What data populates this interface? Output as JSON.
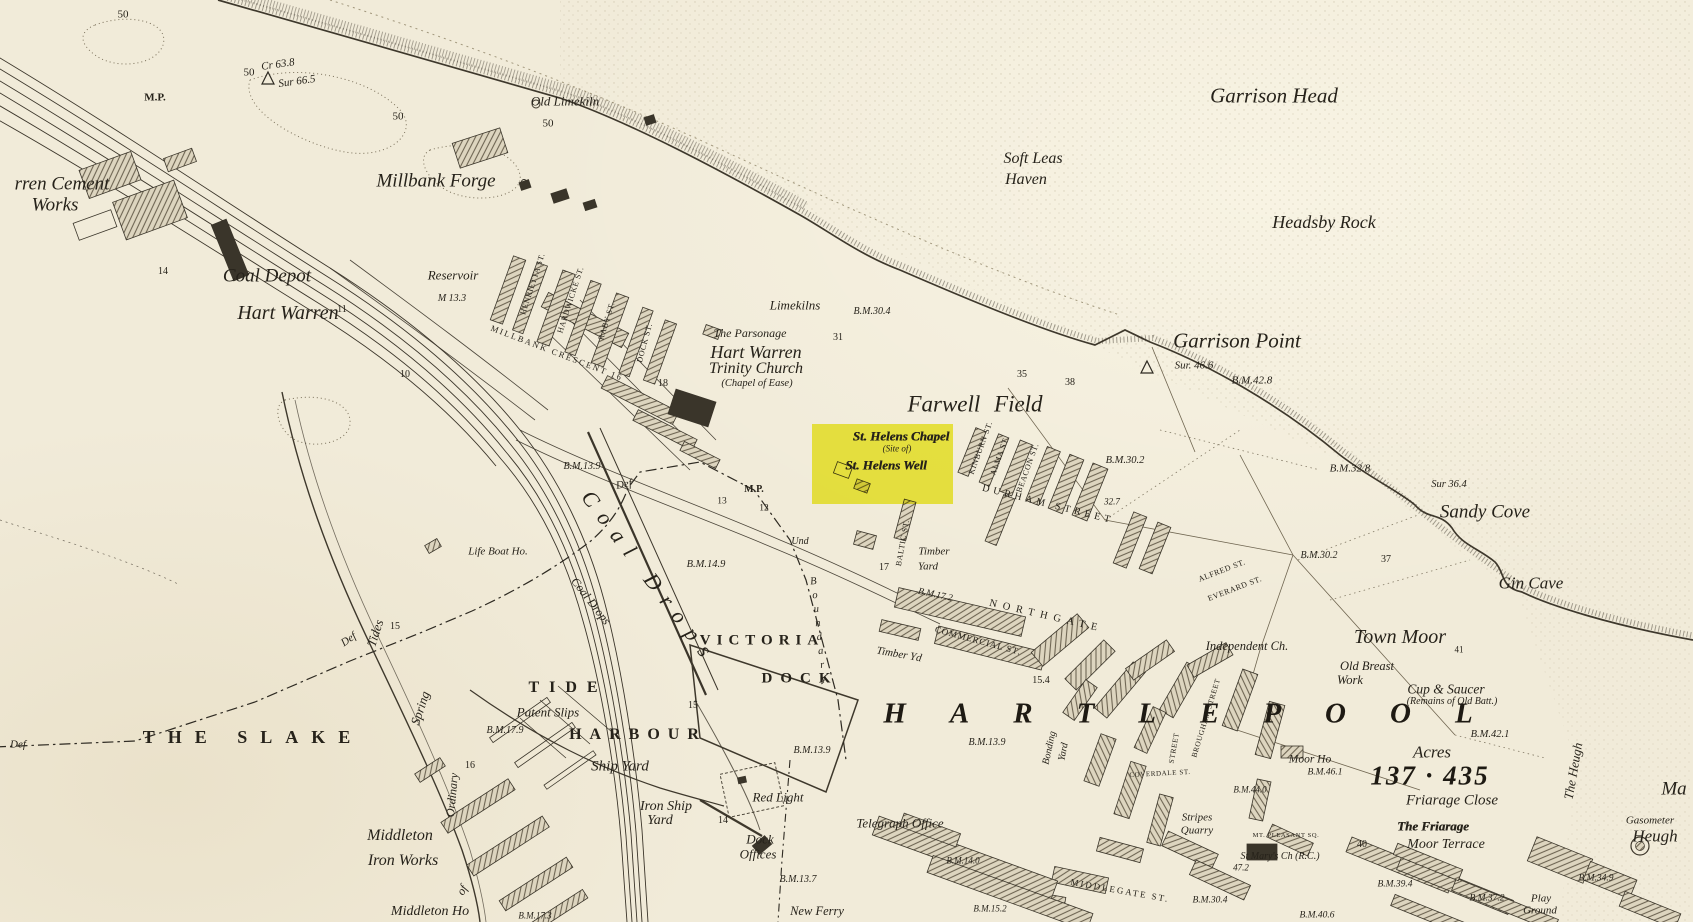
{
  "map_meta": {
    "kind": "historical-ordnance-survey-town-map",
    "highlight_color": "#f0ee2e",
    "paper_color": "#f1ebd9",
    "ink_color": "#2b271f"
  },
  "highlight": {
    "name": "site-of-st-helens-well",
    "fill": "#f0ee2e",
    "lines": [
      "St. Helens Chapel",
      "(Site of)",
      "St. Helens Well"
    ]
  },
  "labels": [
    {
      "t": "50",
      "x": 123,
      "y": 15,
      "s": "num",
      "fs": 11
    },
    {
      "t": "M.P.",
      "x": 155,
      "y": 98,
      "s": "numb",
      "fs": 11
    },
    {
      "t": "Cr 63.8",
      "x": 278,
      "y": 65,
      "s": "bm",
      "fs": 11,
      "r": -8
    },
    {
      "t": "Sur 66.5",
      "x": 297,
      "y": 82,
      "s": "bm",
      "fs": 11,
      "r": -8
    },
    {
      "t": "50",
      "x": 249,
      "y": 73,
      "s": "num",
      "fs": 11
    },
    {
      "t": "50",
      "x": 398,
      "y": 117,
      "s": "num",
      "fs": 11
    },
    {
      "t": "50",
      "x": 548,
      "y": 124,
      "s": "num",
      "fs": 11
    },
    {
      "t": "Old Limekiln",
      "x": 565,
      "y": 101,
      "s": "pl",
      "fs": 13
    },
    {
      "t": "Garrison Head",
      "x": 1274,
      "y": 96,
      "s": "pl",
      "fs": 21
    },
    {
      "t": "Soft Leas",
      "x": 1033,
      "y": 159,
      "s": "pl",
      "fs": 16
    },
    {
      "t": "Haven",
      "x": 1026,
      "y": 180,
      "s": "pl",
      "fs": 16
    },
    {
      "t": "Headsby Rock",
      "x": 1324,
      "y": 222,
      "s": "pl",
      "fs": 18
    },
    {
      "t": "rren Cement",
      "x": 62,
      "y": 184,
      "s": "pl",
      "fs": 19
    },
    {
      "t": "Works",
      "x": 55,
      "y": 205,
      "s": "pl",
      "fs": 19
    },
    {
      "t": "Millbank Forge",
      "x": 436,
      "y": 181,
      "s": "pl",
      "fs": 19
    },
    {
      "t": "Coal Depot",
      "x": 267,
      "y": 276,
      "s": "pl",
      "fs": 19
    },
    {
      "t": "Hart Warren",
      "x": 288,
      "y": 313,
      "s": "pl",
      "fs": 20
    },
    {
      "t": "Reservoir",
      "x": 453,
      "y": 275,
      "s": "pl",
      "fs": 13
    },
    {
      "t": "M 13.3",
      "x": 452,
      "y": 299,
      "s": "bm",
      "fs": 10
    },
    {
      "t": "14",
      "x": 163,
      "y": 272,
      "s": "num",
      "fs": 10
    },
    {
      "t": "11",
      "x": 342,
      "y": 310,
      "s": "num",
      "fs": 10
    },
    {
      "t": "10",
      "x": 405,
      "y": 375,
      "s": "num",
      "fs": 10
    },
    {
      "t": "HENRIETTA ST.",
      "x": 533,
      "y": 284,
      "s": "st",
      "fs": 8,
      "r": -72
    },
    {
      "t": "HARDWICKE ST.",
      "x": 571,
      "y": 300,
      "s": "st",
      "fs": 8,
      "r": -72
    },
    {
      "t": "RABY ST.",
      "x": 607,
      "y": 321,
      "s": "st",
      "fs": 8,
      "r": -73
    },
    {
      "t": "DOCK ST.",
      "x": 645,
      "y": 343,
      "s": "st",
      "fs": 8,
      "r": -75
    },
    {
      "t": "MILLBANK CRESCENT 16",
      "x": 557,
      "y": 353,
      "s": "st",
      "fs": 8.5,
      "ls": 2,
      "r": 21
    },
    {
      "t": "Limekilns",
      "x": 795,
      "y": 305,
      "s": "pl",
      "fs": 13
    },
    {
      "t": "The Parsonage",
      "x": 750,
      "y": 333,
      "s": "pl",
      "fs": 12
    },
    {
      "t": "Hart Warren",
      "x": 756,
      "y": 352,
      "s": "pl",
      "fs": 18
    },
    {
      "t": "Trinity Church",
      "x": 756,
      "y": 369,
      "s": "pl",
      "fs": 16
    },
    {
      "t": "(Chapel of Ease)",
      "x": 757,
      "y": 384,
      "s": "pl",
      "fs": 10.5
    },
    {
      "t": "18",
      "x": 663,
      "y": 384,
      "s": "num",
      "fs": 10
    },
    {
      "t": "31",
      "x": 838,
      "y": 338,
      "s": "num",
      "fs": 10
    },
    {
      "t": "B.M.30.4",
      "x": 872,
      "y": 312,
      "s": "bm",
      "fs": 10
    },
    {
      "t": "35",
      "x": 1022,
      "y": 375,
      "s": "num",
      "fs": 10
    },
    {
      "t": "38",
      "x": 1070,
      "y": 383,
      "s": "num",
      "fs": 10
    },
    {
      "t": "Garrison Point",
      "x": 1237,
      "y": 341,
      "s": "pl",
      "fs": 21
    },
    {
      "t": "Sur. 46.6",
      "x": 1194,
      "y": 366,
      "s": "bm",
      "fs": 11
    },
    {
      "t": "B.M.42.8",
      "x": 1252,
      "y": 381,
      "s": "bm",
      "fs": 11
    },
    {
      "t": "Farwell Field",
      "x": 975,
      "y": 404,
      "s": "pl",
      "fs": 23,
      "ws": 8
    },
    {
      "t": "St. Helens Chapel",
      "x": 901,
      "y": 436,
      "s": "bl",
      "fs": 13
    },
    {
      "t": "(Site of)",
      "x": 897,
      "y": 449,
      "s": "pl",
      "fs": 9
    },
    {
      "t": "St. Helens Well",
      "x": 886,
      "y": 465,
      "s": "bl",
      "fs": 13
    },
    {
      "t": "KINBURN ST.",
      "x": 981,
      "y": 448,
      "s": "st",
      "fs": 8,
      "r": -70
    },
    {
      "t": "ALMA ST.",
      "x": 1000,
      "y": 456,
      "s": "st",
      "fs": 8,
      "r": -70
    },
    {
      "t": "BEACON ST.",
      "x": 1028,
      "y": 468,
      "s": "st",
      "fs": 8,
      "r": -70
    },
    {
      "t": "B.M.30.2",
      "x": 1125,
      "y": 461,
      "s": "bm",
      "fs": 10.5
    },
    {
      "t": "DURHAM STREET",
      "x": 1048,
      "y": 505,
      "s": "st",
      "fs": 10,
      "ls": 4,
      "r": 14
    },
    {
      "t": "32.7",
      "x": 1112,
      "y": 502,
      "s": "bm",
      "fs": 9
    },
    {
      "t": "B.M.32.8",
      "x": 1350,
      "y": 469,
      "s": "bm",
      "fs": 11
    },
    {
      "t": "Sur 36.4",
      "x": 1449,
      "y": 485,
      "s": "bm",
      "fs": 10.5
    },
    {
      "t": "Sandy Cove",
      "x": 1485,
      "y": 512,
      "s": "pl",
      "fs": 19
    },
    {
      "t": "B.M.30.2",
      "x": 1319,
      "y": 556,
      "s": "bm",
      "fs": 10
    },
    {
      "t": "37",
      "x": 1386,
      "y": 560,
      "s": "num",
      "fs": 10
    },
    {
      "t": "Gin Cave",
      "x": 1531,
      "y": 583,
      "s": "pl",
      "fs": 17
    },
    {
      "t": "ALFRED ST.",
      "x": 1222,
      "y": 571,
      "s": "st",
      "fs": 8,
      "r": -21
    },
    {
      "t": "EVERARD ST.",
      "x": 1235,
      "y": 589,
      "s": "st",
      "fs": 8,
      "r": -21
    },
    {
      "t": "Town Moor",
      "x": 1400,
      "y": 637,
      "s": "pl",
      "fs": 20
    },
    {
      "t": "41",
      "x": 1459,
      "y": 650,
      "s": "num",
      "fs": 9
    },
    {
      "t": "Independent Ch.",
      "x": 1247,
      "y": 646,
      "s": "pl",
      "fs": 12.5
    },
    {
      "t": "Old Breast",
      "x": 1367,
      "y": 666,
      "s": "pl",
      "fs": 12.5
    },
    {
      "t": "Work",
      "x": 1350,
      "y": 680,
      "s": "pl",
      "fs": 12.5
    },
    {
      "t": "Cup & Saucer",
      "x": 1446,
      "y": 689,
      "s": "pl",
      "fs": 13.5
    },
    {
      "t": "(Remains of Old Batt.)",
      "x": 1452,
      "y": 702,
      "s": "pl",
      "fs": 10
    },
    {
      "t": "B.M.42.1",
      "x": 1490,
      "y": 735,
      "s": "bm",
      "fs": 10.5
    },
    {
      "t": "Acres",
      "x": 1432,
      "y": 752,
      "s": "pl",
      "fs": 17
    },
    {
      "t": "137 · 435",
      "x": 1430,
      "y": 776,
      "s": "town",
      "fs": 27,
      "ls": 2
    },
    {
      "t": "Friarage Close",
      "x": 1452,
      "y": 801,
      "s": "pl",
      "fs": 15
    },
    {
      "t": "The Friarage",
      "x": 1433,
      "y": 826,
      "s": "bl",
      "fs": 13
    },
    {
      "t": "Moor Terrace",
      "x": 1446,
      "y": 845,
      "s": "pl",
      "fs": 14
    },
    {
      "t": "The Heugh",
      "x": 1573,
      "y": 771,
      "s": "pl",
      "fs": 13,
      "r": -80
    },
    {
      "t": "Gasometer",
      "x": 1650,
      "y": 821,
      "s": "pl",
      "fs": 11
    },
    {
      "t": "Heugh",
      "x": 1655,
      "y": 836,
      "s": "pl",
      "fs": 17
    },
    {
      "t": "Ma",
      "x": 1674,
      "y": 789,
      "s": "pl",
      "fs": 19
    },
    {
      "t": "Moor Ho",
      "x": 1310,
      "y": 760,
      "s": "pl",
      "fs": 11.5
    },
    {
      "t": "B.M.46.1",
      "x": 1325,
      "y": 773,
      "s": "bm",
      "fs": 9.5
    },
    {
      "t": "40",
      "x": 1362,
      "y": 845,
      "s": "num",
      "fs": 10
    },
    {
      "t": "MT. PLEASANT SQ.",
      "x": 1286,
      "y": 836,
      "s": "st",
      "fs": 6.5
    },
    {
      "t": "St Mary's Ch (R.C.)",
      "x": 1280,
      "y": 857,
      "s": "pl",
      "fs": 10
    },
    {
      "t": "47.2",
      "x": 1241,
      "y": 868,
      "s": "bm",
      "fs": 9
    },
    {
      "t": "Stripes",
      "x": 1197,
      "y": 818,
      "s": "pl",
      "fs": 11
    },
    {
      "t": "Quarry",
      "x": 1197,
      "y": 831,
      "s": "pl",
      "fs": 11
    },
    {
      "t": "COVERDALE ST.",
      "x": 1160,
      "y": 774,
      "s": "st",
      "fs": 7,
      "r": -3
    },
    {
      "t": "BROUGHAM STREET",
      "x": 1206,
      "y": 718,
      "s": "st",
      "fs": 7.5,
      "r": -73
    },
    {
      "t": "STREET",
      "x": 1174,
      "y": 748,
      "s": "st",
      "fs": 7.5,
      "r": -80
    },
    {
      "t": "MIDDLEGATE ST.",
      "x": 1120,
      "y": 891,
      "s": "st",
      "fs": 9,
      "ls": 2,
      "r": 10
    },
    {
      "t": "B.M.30.4",
      "x": 1210,
      "y": 901,
      "s": "bm",
      "fs": 9.5
    },
    {
      "t": "B.M.44.0",
      "x": 1250,
      "y": 790,
      "s": "bm",
      "fs": 9
    },
    {
      "t": "B.M.39.4",
      "x": 1395,
      "y": 885,
      "s": "bm",
      "fs": 9.5
    },
    {
      "t": "B.M.37.2",
      "x": 1487,
      "y": 899,
      "s": "bm",
      "fs": 9.5
    },
    {
      "t": "Play",
      "x": 1541,
      "y": 899,
      "s": "pl",
      "fs": 11
    },
    {
      "t": "Ground",
      "x": 1540,
      "y": 911,
      "s": "pl",
      "fs": 11
    },
    {
      "t": "B.M.34.9",
      "x": 1596,
      "y": 879,
      "s": "bm",
      "fs": 9.5
    },
    {
      "t": "B.M.40.6",
      "x": 1317,
      "y": 916,
      "s": "bm",
      "fs": 9.5
    },
    {
      "t": "HARTLEPOOL",
      "x": 1200,
      "y": 714,
      "s": "town",
      "fs": 29,
      "ls": 44
    },
    {
      "t": "Bonding",
      "x": 1050,
      "y": 748,
      "s": "pl",
      "fs": 10,
      "r": -78
    },
    {
      "t": "Yard",
      "x": 1064,
      "y": 752,
      "s": "pl",
      "fs": 10,
      "r": -78
    },
    {
      "t": "B.M.13.9",
      "x": 987,
      "y": 743,
      "s": "bm",
      "fs": 10
    },
    {
      "t": "B.M.13.9",
      "x": 812,
      "y": 751,
      "s": "bm",
      "fs": 10
    },
    {
      "t": "15.4",
      "x": 1041,
      "y": 681,
      "s": "num",
      "fs": 10
    },
    {
      "t": "COMMERCIAL ST.",
      "x": 978,
      "y": 641,
      "s": "st",
      "fs": 9,
      "ls": 1,
      "r": 15
    },
    {
      "t": "NORTHGATE",
      "x": 1046,
      "y": 617,
      "s": "st",
      "fs": 10.5,
      "ls": 6,
      "r": 13
    },
    {
      "t": "B.M.17.2",
      "x": 935,
      "y": 596,
      "s": "bm",
      "fs": 9.5,
      "r": 12
    },
    {
      "t": "Timber Yd",
      "x": 899,
      "y": 655,
      "s": "pl",
      "fs": 11,
      "r": 10
    },
    {
      "t": "VICTORIA",
      "x": 762,
      "y": 641,
      "s": "sp",
      "fs": 15,
      "ls": 6
    },
    {
      "t": "DOCK",
      "x": 800,
      "y": 679,
      "s": "sp",
      "fs": 15,
      "ls": 8
    },
    {
      "t": "TIDE",
      "x": 568,
      "y": 688,
      "s": "sp",
      "fs": 16,
      "ls": 10
    },
    {
      "t": "HARBOUR",
      "x": 638,
      "y": 735,
      "s": "sp",
      "fs": 16,
      "ls": 8
    },
    {
      "t": "THE SLAKE",
      "x": 253,
      "y": 737,
      "s": "sp",
      "fs": 18,
      "ls": 13
    },
    {
      "t": "Patent Slips",
      "x": 548,
      "y": 712,
      "s": "pl",
      "fs": 13
    },
    {
      "t": "B.M.17.9",
      "x": 505,
      "y": 731,
      "s": "bm",
      "fs": 10
    },
    {
      "t": "Ship Yard",
      "x": 620,
      "y": 767,
      "s": "pl",
      "fs": 15
    },
    {
      "t": "Iron Ship",
      "x": 666,
      "y": 807,
      "s": "pl",
      "fs": 14
    },
    {
      "t": "Yard",
      "x": 660,
      "y": 821,
      "s": "pl",
      "fs": 14
    },
    {
      "t": "Red Light",
      "x": 778,
      "y": 797,
      "s": "pl",
      "fs": 13
    },
    {
      "t": "14",
      "x": 723,
      "y": 821,
      "s": "num",
      "fs": 10
    },
    {
      "t": "Dock",
      "x": 760,
      "y": 839,
      "s": "pl",
      "fs": 13
    },
    {
      "t": "Offices",
      "x": 758,
      "y": 854,
      "s": "pl",
      "fs": 13
    },
    {
      "t": "Telegraph Office",
      "x": 900,
      "y": 823,
      "s": "pl",
      "fs": 13
    },
    {
      "t": "B.M.13.7",
      "x": 798,
      "y": 880,
      "s": "bm",
      "fs": 10
    },
    {
      "t": "New Ferry",
      "x": 817,
      "y": 911,
      "s": "pl",
      "fs": 12.5
    },
    {
      "t": "B.M.14.0",
      "x": 963,
      "y": 861,
      "s": "bm",
      "fs": 9
    },
    {
      "t": "B.M.15.2",
      "x": 990,
      "y": 909,
      "s": "bm",
      "fs": 9
    },
    {
      "t": "Middleton",
      "x": 400,
      "y": 836,
      "s": "pl",
      "fs": 16
    },
    {
      "t": "Iron Works",
      "x": 403,
      "y": 861,
      "s": "pl",
      "fs": 16
    },
    {
      "t": "Middleton Ho",
      "x": 430,
      "y": 912,
      "s": "pl",
      "fs": 14
    },
    {
      "t": "B.M.17.3",
      "x": 535,
      "y": 916,
      "s": "bm",
      "fs": 9
    },
    {
      "t": "Life Boat Ho.",
      "x": 498,
      "y": 552,
      "s": "pl",
      "fs": 11
    },
    {
      "t": "Coal Drops",
      "x": 591,
      "y": 601,
      "s": "pl",
      "fs": 12,
      "r": 52
    },
    {
      "t": "Coal Drops",
      "x": 650,
      "y": 578,
      "s": "pl",
      "fs": 22,
      "ls": 11,
      "r": 53
    },
    {
      "t": "B.M.13.9",
      "x": 582,
      "y": 467,
      "s": "bm",
      "fs": 10
    },
    {
      "t": "B.M.14.9",
      "x": 706,
      "y": 565,
      "s": "bm",
      "fs": 10.5
    },
    {
      "t": "M.P.",
      "x": 754,
      "y": 490,
      "s": "numb",
      "fs": 10
    },
    {
      "t": "13",
      "x": 722,
      "y": 502,
      "s": "num",
      "fs": 9.5
    },
    {
      "t": "12",
      "x": 764,
      "y": 509,
      "s": "num",
      "fs": 9.5
    },
    {
      "t": "Def",
      "x": 624,
      "y": 485,
      "s": "pl",
      "fs": 11,
      "r": -10
    },
    {
      "t": "Def",
      "x": 349,
      "y": 640,
      "s": "pl",
      "fs": 11,
      "r": -35
    },
    {
      "t": "Def",
      "x": 18,
      "y": 745,
      "s": "pl",
      "fs": 11
    },
    {
      "t": "Tides",
      "x": 375,
      "y": 633,
      "s": "pl",
      "fs": 13,
      "r": -72
    },
    {
      "t": "Spring",
      "x": 420,
      "y": 708,
      "s": "pl",
      "fs": 13,
      "r": -72
    },
    {
      "t": "Ordinary",
      "x": 452,
      "y": 795,
      "s": "pl",
      "fs": 12,
      "r": -85
    },
    {
      "t": "of",
      "x": 462,
      "y": 890,
      "s": "pl",
      "fs": 12,
      "r": -60
    },
    {
      "t": "Und",
      "x": 800,
      "y": 542,
      "s": "pl",
      "fs": 10
    },
    {
      "t": "Boundary",
      "x": 818,
      "y": 632,
      "s": "vs",
      "fs": 10.5,
      "ls": 3,
      "r": -6
    },
    {
      "t": "BALTIC ST.",
      "x": 903,
      "y": 543,
      "s": "st",
      "fs": 8,
      "r": -80
    },
    {
      "t": "Timber",
      "x": 934,
      "y": 552,
      "s": "pl",
      "fs": 11
    },
    {
      "t": "Yard",
      "x": 928,
      "y": 567,
      "s": "pl",
      "fs": 11
    },
    {
      "t": "17",
      "x": 884,
      "y": 568,
      "s": "num",
      "fs": 10
    },
    {
      "t": "15",
      "x": 693,
      "y": 706,
      "s": "num",
      "fs": 10
    },
    {
      "t": "15",
      "x": 395,
      "y": 627,
      "s": "num",
      "fs": 10
    },
    {
      "t": "16",
      "x": 470,
      "y": 766,
      "s": "num",
      "fs": 10
    }
  ]
}
